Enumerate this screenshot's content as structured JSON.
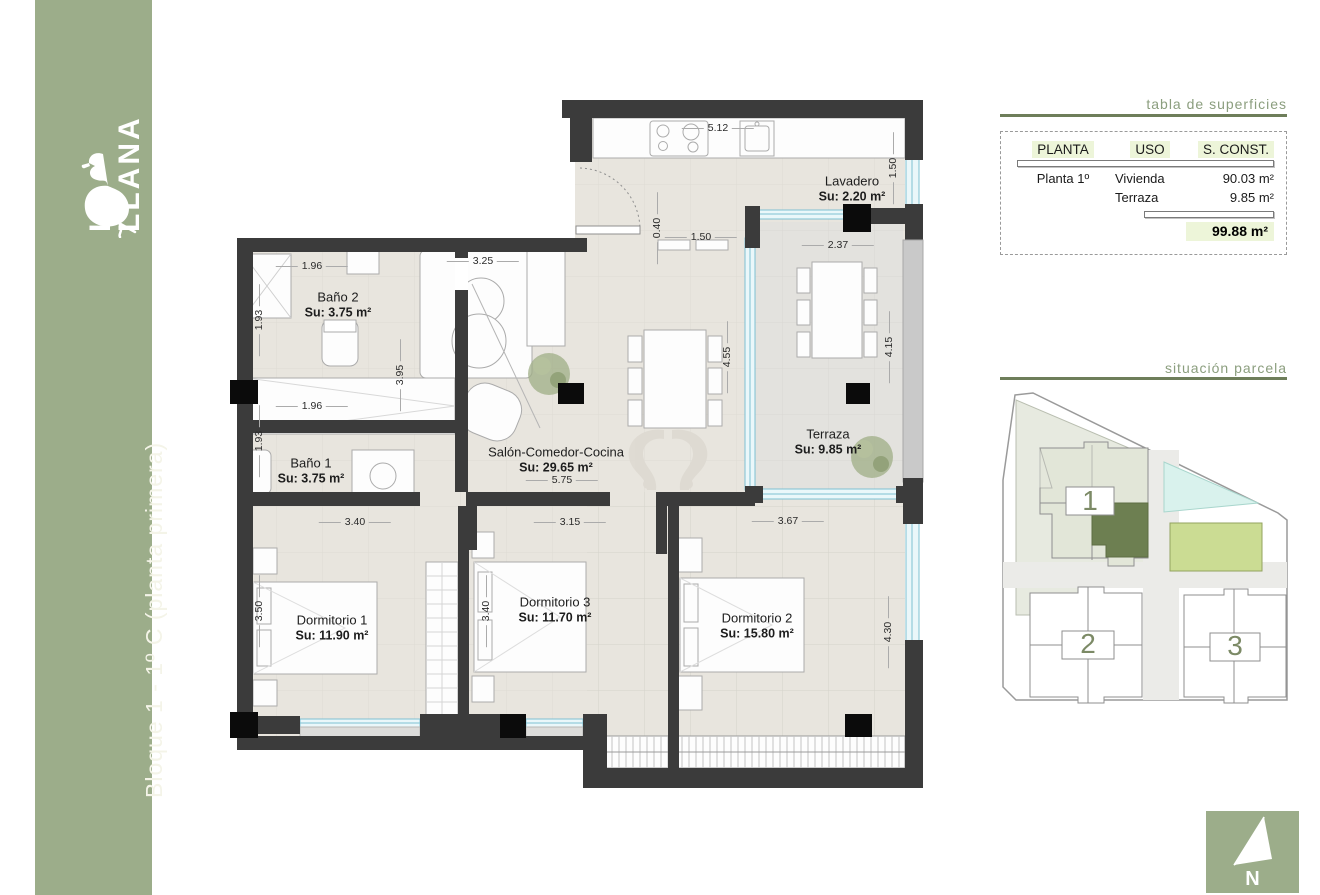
{
  "sidebar": {
    "logo_line1": "LA",
    "logo_line2": "LLANA",
    "logo_line3": "towers",
    "vertical_title": "Bloque 1 - 1º C (planta primera)"
  },
  "floor_plan": {
    "rooms": [
      {
        "name": "Lavadero",
        "area": "Su: 2.20 m²"
      },
      {
        "name": "Baño 2",
        "area": "Su: 3.75 m²"
      },
      {
        "name": "Baño 1",
        "area": "Su: 3.75 m²"
      },
      {
        "name": "Salón-Comedor-Cocina",
        "area": "Su: 29.65 m²"
      },
      {
        "name": "Terraza",
        "area": "Su: 9.85 m²"
      },
      {
        "name": "Dormitorio 1",
        "area": "Su: 11.90 m²"
      },
      {
        "name": "Dormitorio 3",
        "area": "Su: 11.70 m²"
      },
      {
        "name": "Dormitorio 2",
        "area": "Su: 15.80 m²"
      }
    ],
    "dims": [
      "5.12",
      "1.50",
      "0.40",
      "1.50",
      "2.37",
      "1.96",
      "3.25",
      "1.93",
      "3.95",
      "4.55",
      "4.15",
      "1.96",
      "1.93",
      "5.75",
      "3.40",
      "3.15",
      "3.67",
      "3.50",
      "3.40",
      "4.30"
    ]
  },
  "surface_table": {
    "title": "tabla de superficies",
    "headers": [
      "PLANTA",
      "USO",
      "S. CONST."
    ],
    "rows": [
      {
        "planta": "Planta 1º",
        "uso": "Vivienda",
        "sconst": "90.03 m²"
      },
      {
        "planta": "",
        "uso": "Terraza",
        "sconst": "9.85 m²"
      }
    ],
    "total": "99.88 m²"
  },
  "site_plan": {
    "title": "situación parcela",
    "blocks": [
      {
        "label": "1"
      },
      {
        "label": "2"
      },
      {
        "label": "3"
      }
    ]
  },
  "compass": {
    "label": "N"
  },
  "colors": {
    "sidebar_green": "#9CAD8A",
    "wall_dark": "#3B3B3B",
    "column_black": "#0B0B0B",
    "floor_beige": "#E8E5DE",
    "window_blue": "#7FC0D2",
    "panel_title_green": "#8B9E7E",
    "rule_olive": "#6E7E5A",
    "highlight_green": "#EDF5D9",
    "selected_unit_green": "#6D7F51",
    "pool_cyan": "#D9F2ED",
    "garden_green": "#CBDC93"
  }
}
